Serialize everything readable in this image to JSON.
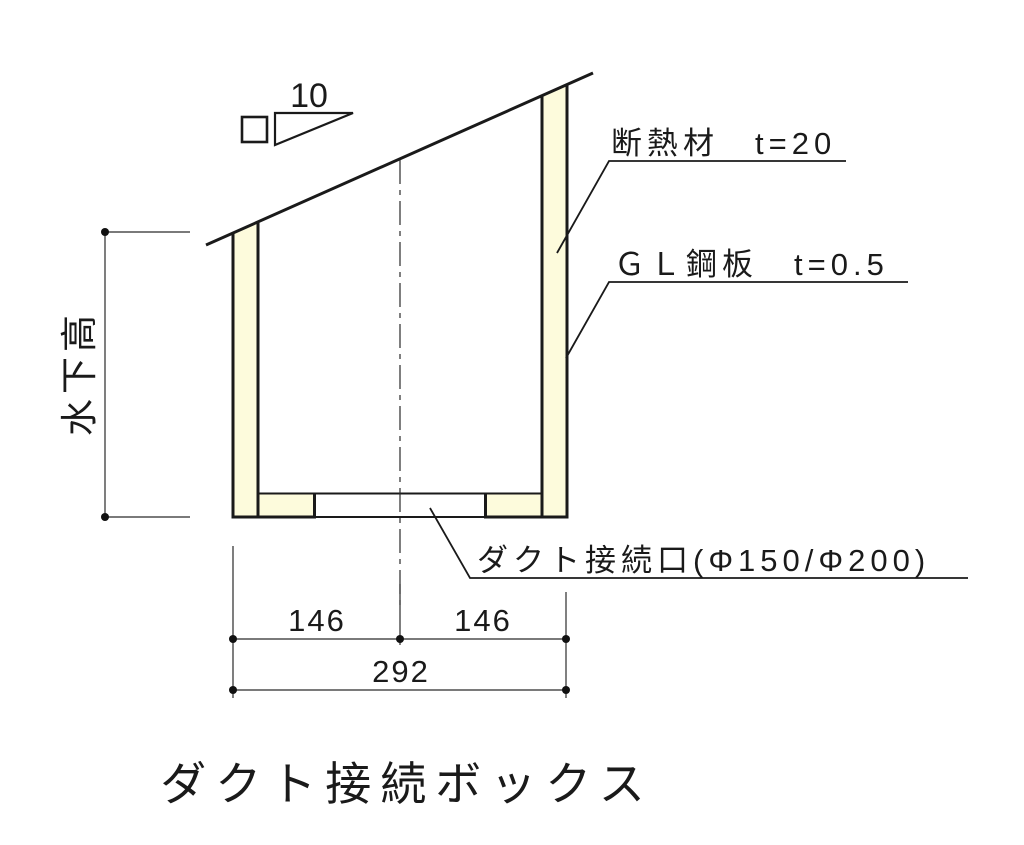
{
  "drawing": {
    "title": "ダクト接続ボックス",
    "slope": {
      "value": "10"
    },
    "labels": {
      "insulation": "断熱材　t=20",
      "steel_plate": "ＧＬ鋼板　t=0.5",
      "duct_port": "ダクト接続口(Φ150/Φ200)",
      "height": "水下高"
    },
    "dimensions": {
      "left_half": "146",
      "right_half": "146",
      "total_width": "292"
    },
    "colors": {
      "insulation_fill": "#FDFBDC",
      "line": "#1a1a1a",
      "background": "#ffffff"
    }
  }
}
